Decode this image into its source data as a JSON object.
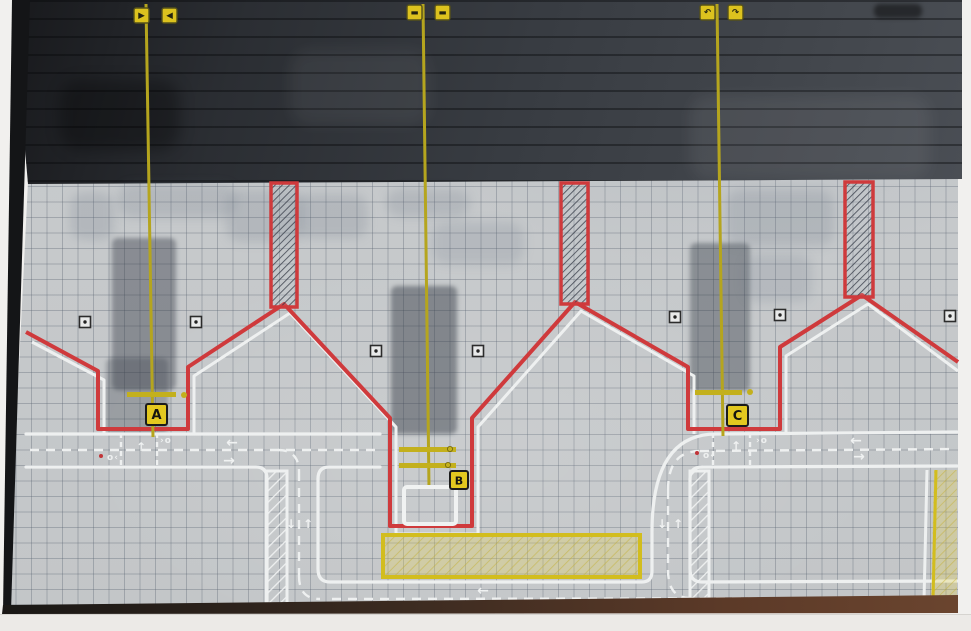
{
  "diagram": {
    "stands": [
      {
        "label": "A"
      },
      {
        "label": "B"
      },
      {
        "label": "C"
      }
    ],
    "top_signs": [
      {
        "id": "a-left",
        "glyph": "▶"
      },
      {
        "id": "a-right",
        "glyph": "◀"
      },
      {
        "id": "b-left",
        "glyph": "▬"
      },
      {
        "id": "b-right",
        "glyph": "▬"
      },
      {
        "id": "c-left",
        "glyph": "↶"
      },
      {
        "id": "c-right",
        "glyph": "↷"
      }
    ],
    "road_arrows": {
      "left": "←",
      "right": "→",
      "up": "↑",
      "down": "↓"
    },
    "junction_marks": {
      "up_arrow": "↑",
      "chevron_dot": "›o",
      "dot_chevron": "o‹"
    },
    "colors": {
      "boundary_red": "#cf3a3c",
      "marking_white": "#eef0f0",
      "taxi_yellow": "#b5a51e",
      "sign_yellow": "#e3c81f",
      "paper_grey": "#c6c9cb",
      "board_dark": "#3a3d42",
      "restricted_yellow": "#d2bd1e"
    }
  }
}
